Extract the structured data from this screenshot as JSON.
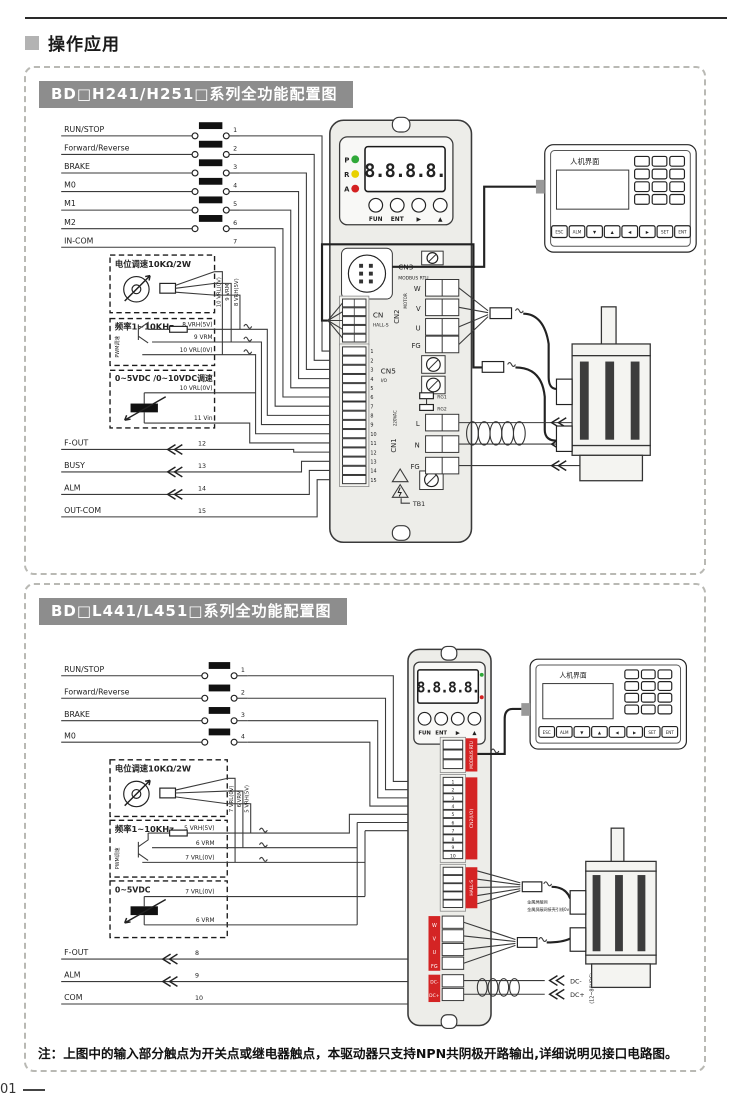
{
  "header": {
    "title": "操作应用"
  },
  "page_number": "01",
  "note": "注：上图中的输入部分触点为开关点或继电器触点，本驱动器只支持NPN共阴极开路输出,详细说明见接口电路图。",
  "colors": {
    "accent_red": "#d42424",
    "led_green": "#2fa838",
    "led_yellow": "#e8d100",
    "led_red": "#d42020",
    "digit_red": "#e01515",
    "title_bg": "#8d8d8d"
  },
  "panel1": {
    "title": "BD□H241/H251□系列全功能配置图",
    "inputs": [
      {
        "label": "RUN/STOP",
        "pin": "1"
      },
      {
        "label": "Forward/Reverse",
        "pin": "2"
      },
      {
        "label": "BRAKE",
        "pin": "3"
      },
      {
        "label": "M0",
        "pin": "4"
      },
      {
        "label": "M1",
        "pin": "5"
      },
      {
        "label": "M2",
        "pin": "6"
      },
      {
        "label": "IN-COM",
        "pin": "7"
      }
    ],
    "pot": {
      "title": "电位调速10KΩ/2W"
    },
    "pot_wires": [
      "10 VRL(0V)",
      "9 VRM",
      "8 VRH(5V)"
    ],
    "pwm": {
      "title": "频率1~10KHz",
      "side": "PWM调速",
      "wires": [
        "8 VRH(5V)",
        "9 VRM",
        "10 VRL(0V)"
      ]
    },
    "vdc": {
      "title": "0~5VDC /0~10VDC调速",
      "wires": [
        "10 VRL(0V)",
        "11 Vin"
      ]
    },
    "outputs": [
      {
        "label": "F-OUT",
        "pin": "12"
      },
      {
        "label": "BUSY",
        "pin": "13"
      },
      {
        "label": "ALM",
        "pin": "14"
      },
      {
        "label": "OUT-COM",
        "pin": "15"
      }
    ],
    "driver": {
      "leds": [
        {
          "label": "P"
        },
        {
          "label": "R"
        },
        {
          "label": "A"
        }
      ],
      "display": "8.8.8.8.",
      "fun": "FUN",
      "ent": "ENT",
      "right": "▶",
      "up": "▲",
      "cn3": "CN3",
      "cn3_sub": "MODBUS RTU",
      "cn_hall": "CN",
      "cn_hall_sub": "HALL-S",
      "cn5": "CN5",
      "cn5_sub": "I/O",
      "io_pins": [
        "1",
        "2",
        "3",
        "4",
        "5",
        "6",
        "7",
        "8",
        "9",
        "10",
        "11",
        "12",
        "13",
        "14",
        "15"
      ],
      "cn2": "CN2",
      "cn2_sub": "MOTOR",
      "motor_terms": [
        "W",
        "V",
        "U",
        "FG"
      ],
      "rg1": "RG1",
      "rg2": "RG2",
      "cn1": "CN1",
      "cn1_sub": "220VAC",
      "power_terms": [
        "L",
        "N",
        "FG"
      ],
      "tb1": "TB1"
    },
    "hmi": {
      "title": "人机界面",
      "keys": [
        "ESC",
        "ALM",
        "▼",
        "▲",
        "◀",
        "▶",
        "SET",
        "ENT"
      ]
    },
    "mains": {
      "l": "L",
      "n": "N",
      "volt": "(220VAC)",
      "fg": "FG"
    }
  },
  "panel2": {
    "title": "BD□L441/L451□系列全功能配置图",
    "inputs": [
      {
        "label": "RUN/STOP",
        "pin": "1"
      },
      {
        "label": "Forward/Reverse",
        "pin": "2"
      },
      {
        "label": "BRAKE",
        "pin": "3"
      },
      {
        "label": "M0",
        "pin": "4"
      }
    ],
    "pot": {
      "title": "电位调速10KΩ/2W"
    },
    "pot_wires": [
      "7 VRL(0V)",
      "6 VRM",
      "5 VRH(5V)"
    ],
    "pwm": {
      "title": "频率1~10KHz",
      "side": "PWM调速",
      "wires": [
        "5 VRH(5V)",
        "6 VRM",
        "7 VRL(0V)"
      ]
    },
    "vdc": {
      "title": "0~5VDC",
      "wires": [
        "7 VRL(0V)",
        "6 VRM"
      ]
    },
    "outputs": [
      {
        "label": "F-OUT",
        "pin": "8"
      },
      {
        "label": "ALM",
        "pin": "9"
      },
      {
        "label": "COM",
        "pin": "10"
      }
    ],
    "driver": {
      "display": "8.8.8.8.",
      "fun": "FUN",
      "ent": "ENT",
      "right": "▶",
      "up": "▲",
      "bar_a": "MODBUS RTU",
      "bar_b": "CN2(I/O)",
      "bar_c": "HALL-S",
      "io_pins": [
        "1",
        "2",
        "3",
        "4",
        "5",
        "6",
        "7",
        "8",
        "9",
        "10"
      ],
      "motor_terms": [
        "W",
        "V",
        "U",
        "FG"
      ],
      "dc_terms": [
        "DC-",
        "DC+"
      ]
    },
    "hmi": {
      "title": "人机界面",
      "keys": [
        "ESC",
        "ALM",
        "▼",
        "▲",
        "◀",
        "▶",
        "SET",
        "ENT"
      ]
    },
    "shield_note1": "金属屏蔽网",
    "shield_note2": "金属屏蔽网接壳引线0v",
    "dc_out": {
      "minus": "DC-",
      "plus": "DC+",
      "volt": "(12~80VDC)"
    }
  }
}
